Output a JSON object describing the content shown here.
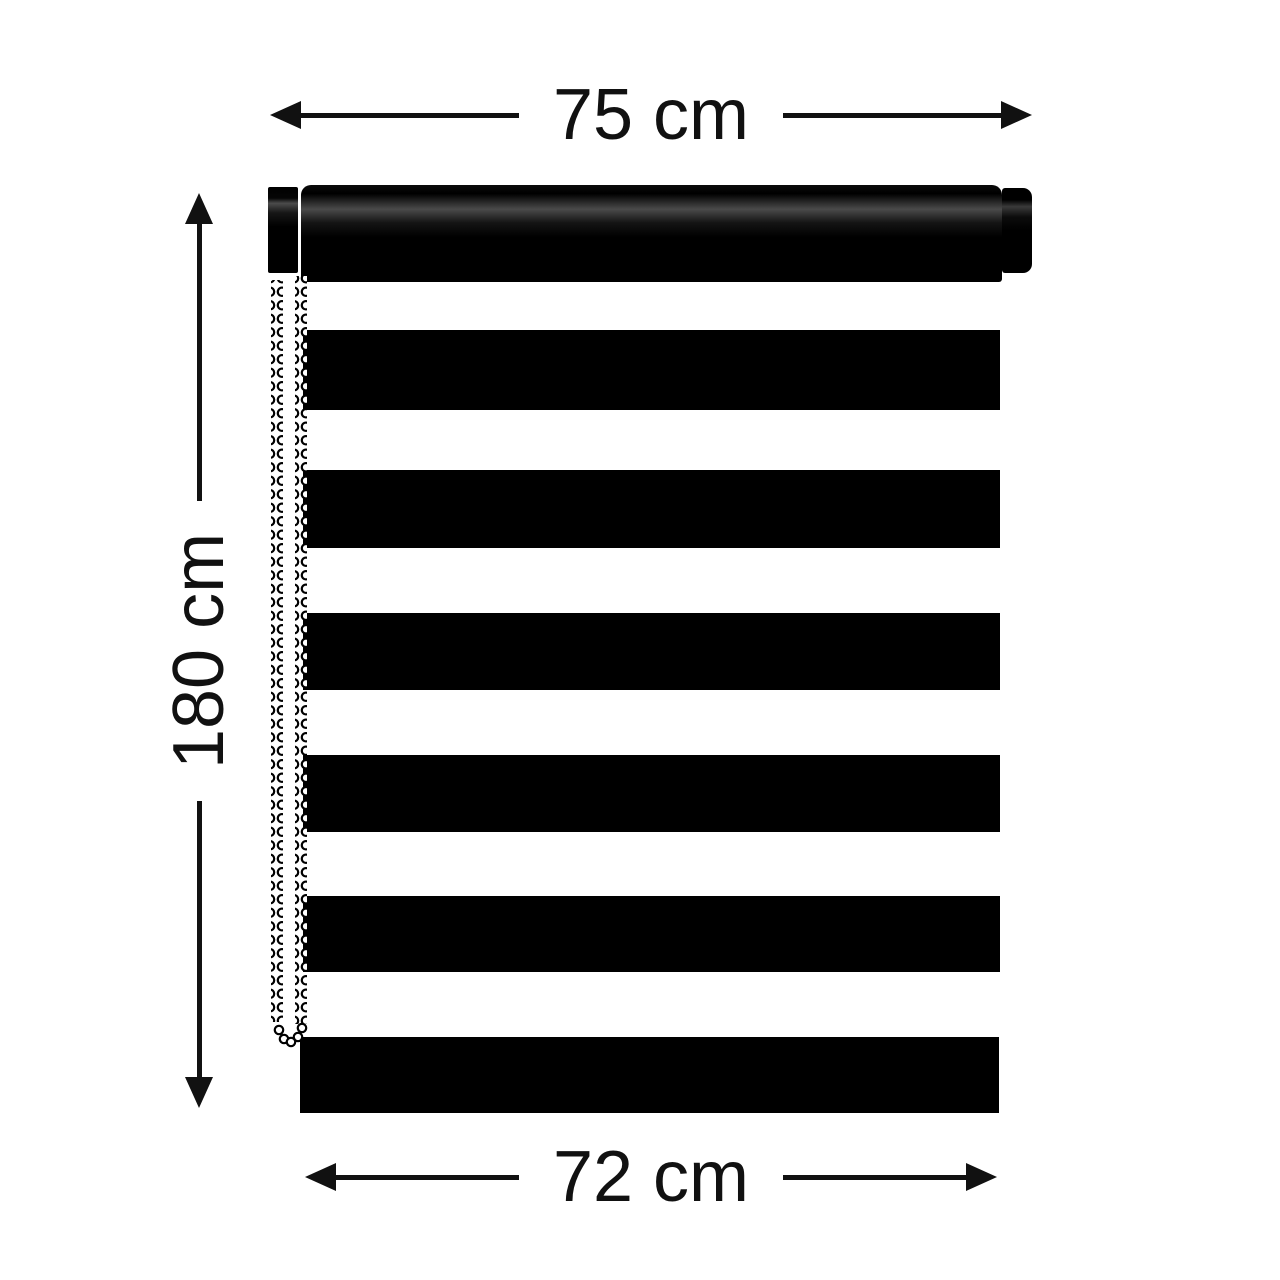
{
  "diagram": {
    "dimensions": {
      "top_width": "75 cm",
      "height": "180 cm",
      "bottom_width": "72 cm"
    }
  },
  "colors": {
    "background": "#ffffff",
    "ink": "#111111",
    "blind": "#000000",
    "chain_bead": "#ffffff"
  },
  "icons": {
    "arrow_left": "arrow-left-icon",
    "arrow_right": "arrow-right-icon",
    "arrow_up": "arrow-up-icon",
    "arrow_down": "arrow-down-icon"
  }
}
